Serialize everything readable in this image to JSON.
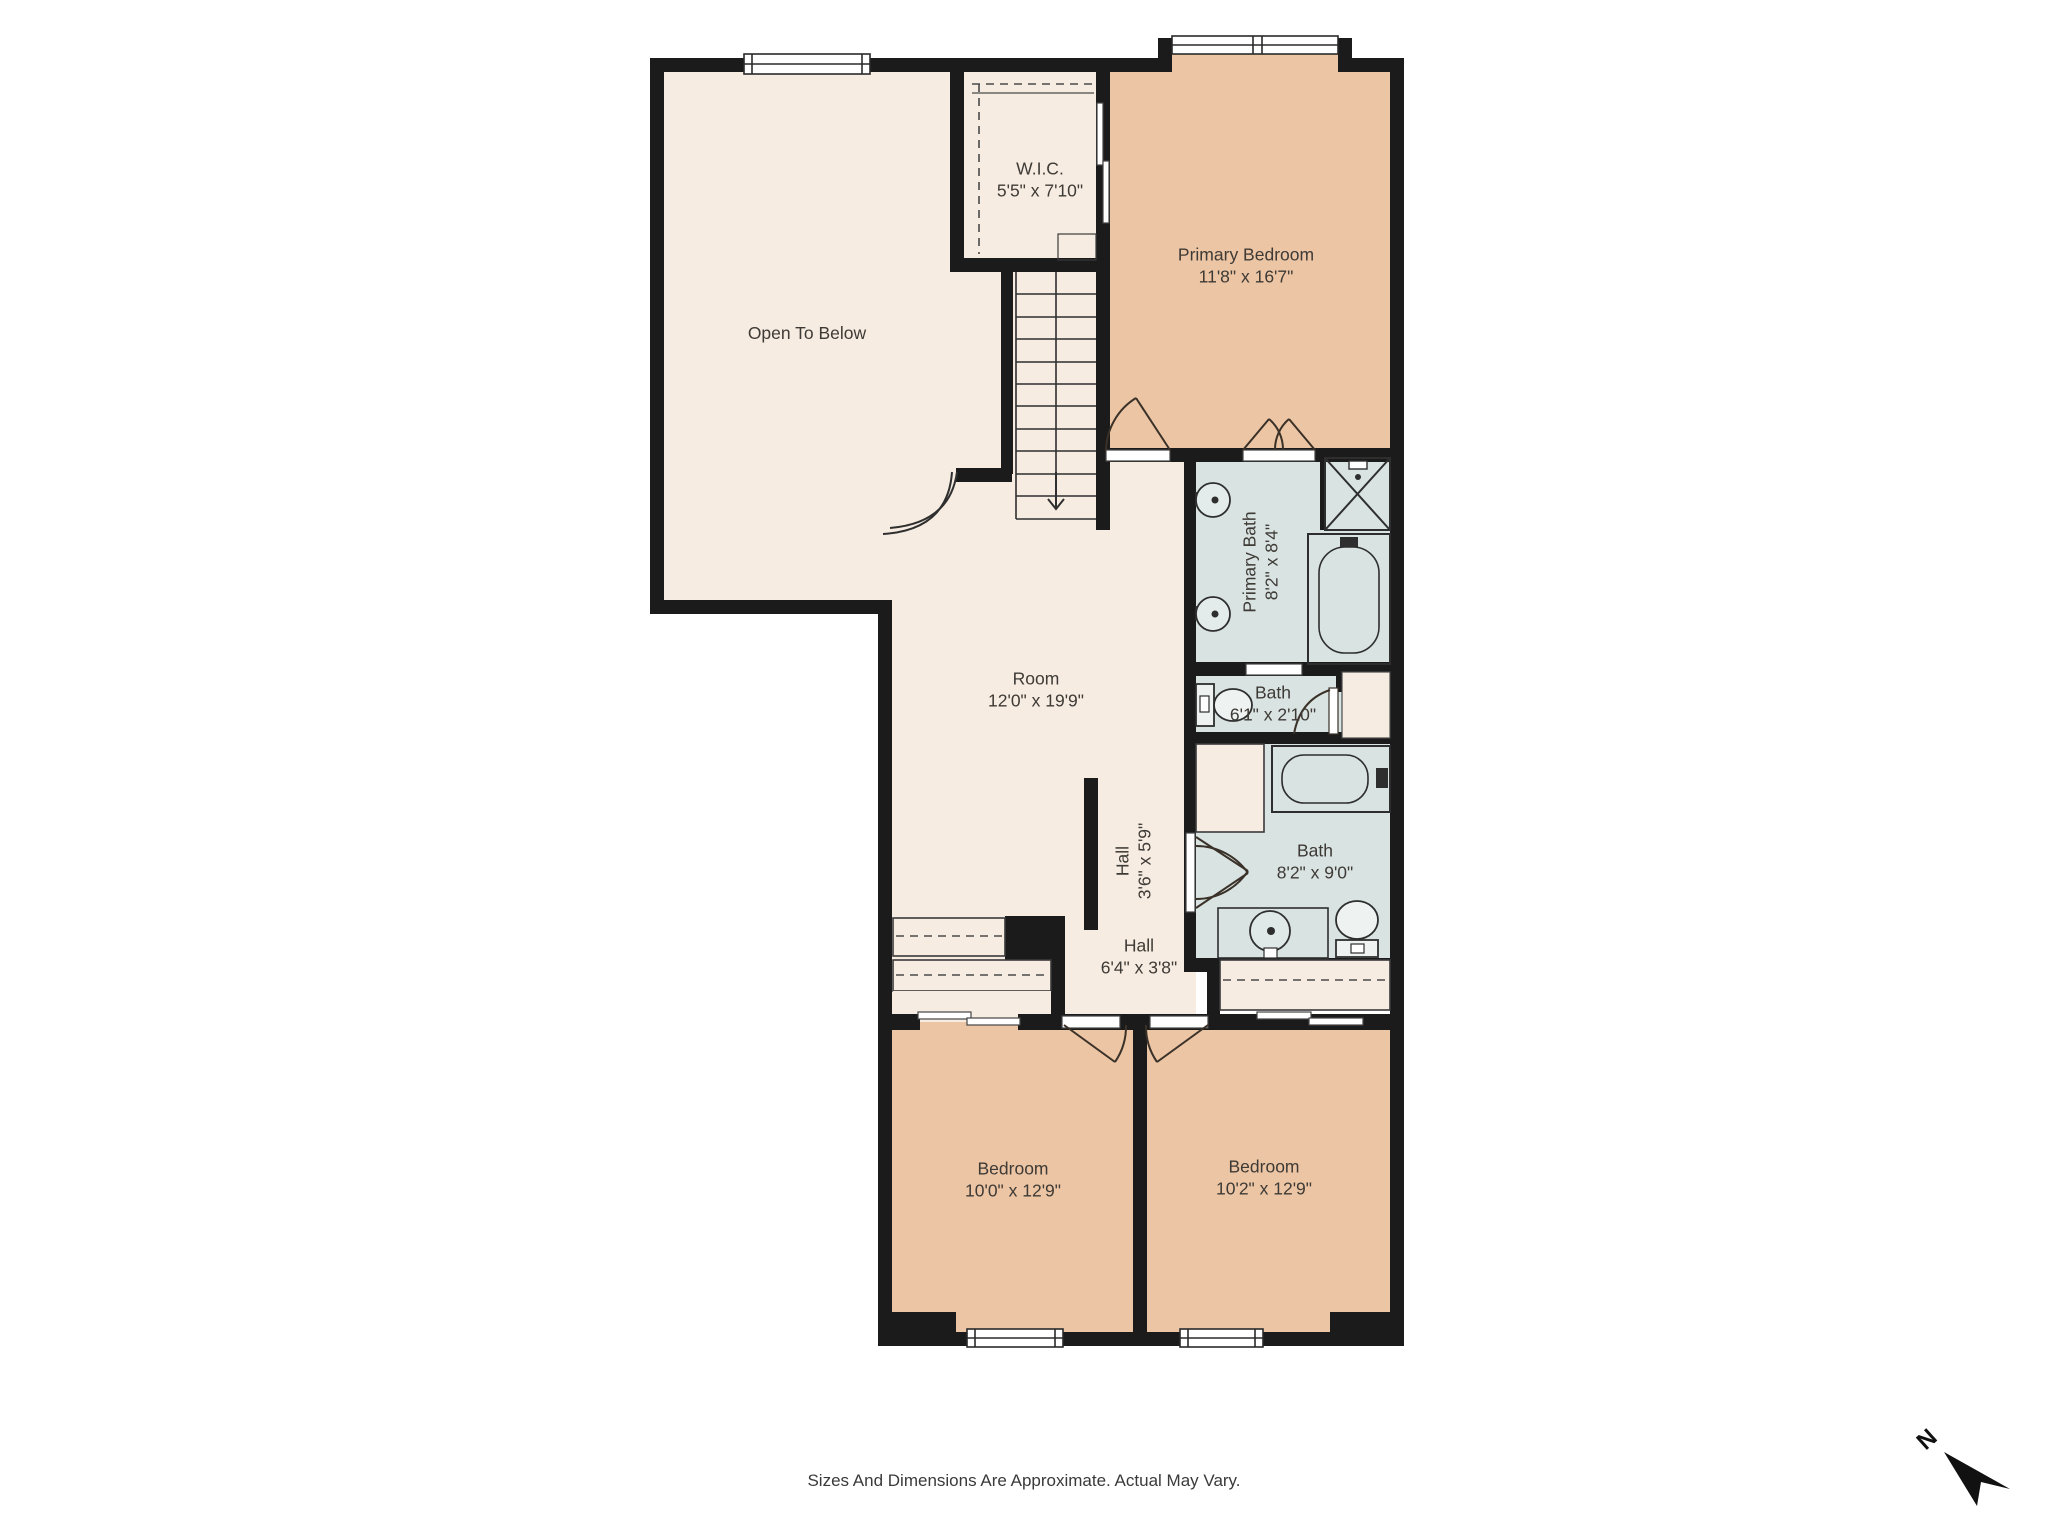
{
  "rooms": {
    "open_to_below": {
      "name": "Open To Below",
      "dims": ""
    },
    "wic": {
      "name": "W.I.C.",
      "dims": "5'5\" x 7'10\""
    },
    "primary_bedroom": {
      "name": "Primary Bedroom",
      "dims": "11'8\" x 16'7\""
    },
    "room": {
      "name": "Room",
      "dims": "12'0\" x 19'9\""
    },
    "primary_bath": {
      "name": "Primary Bath",
      "dims": "8'2\" x 8'4\""
    },
    "bath_small": {
      "name": "Bath",
      "dims": "6'1\" x 2'10\""
    },
    "hall_vertical": {
      "name": "Hall",
      "dims": "3'6\" x 5'9\""
    },
    "hall": {
      "name": "Hall",
      "dims": "6'4\" x 3'8\""
    },
    "bath": {
      "name": "Bath",
      "dims": "8'2\" x 9'0\""
    },
    "bedroom_left": {
      "name": "Bedroom",
      "dims": "10'0\" x 12'9\""
    },
    "bedroom_right": {
      "name": "Bedroom",
      "dims": "10'2\" x 12'9\""
    }
  },
  "footer": {
    "disclaimer": "Sizes And Dimensions Are Approximate. Actual May Vary."
  },
  "compass": {
    "label": "N"
  },
  "colors": {
    "wall": "#1b1b1b",
    "room_fill": "#f6ece2",
    "bedroom_fill": "#ecc5a4",
    "bath_fill": "#d8e3e2",
    "text": "#3e3a35"
  }
}
